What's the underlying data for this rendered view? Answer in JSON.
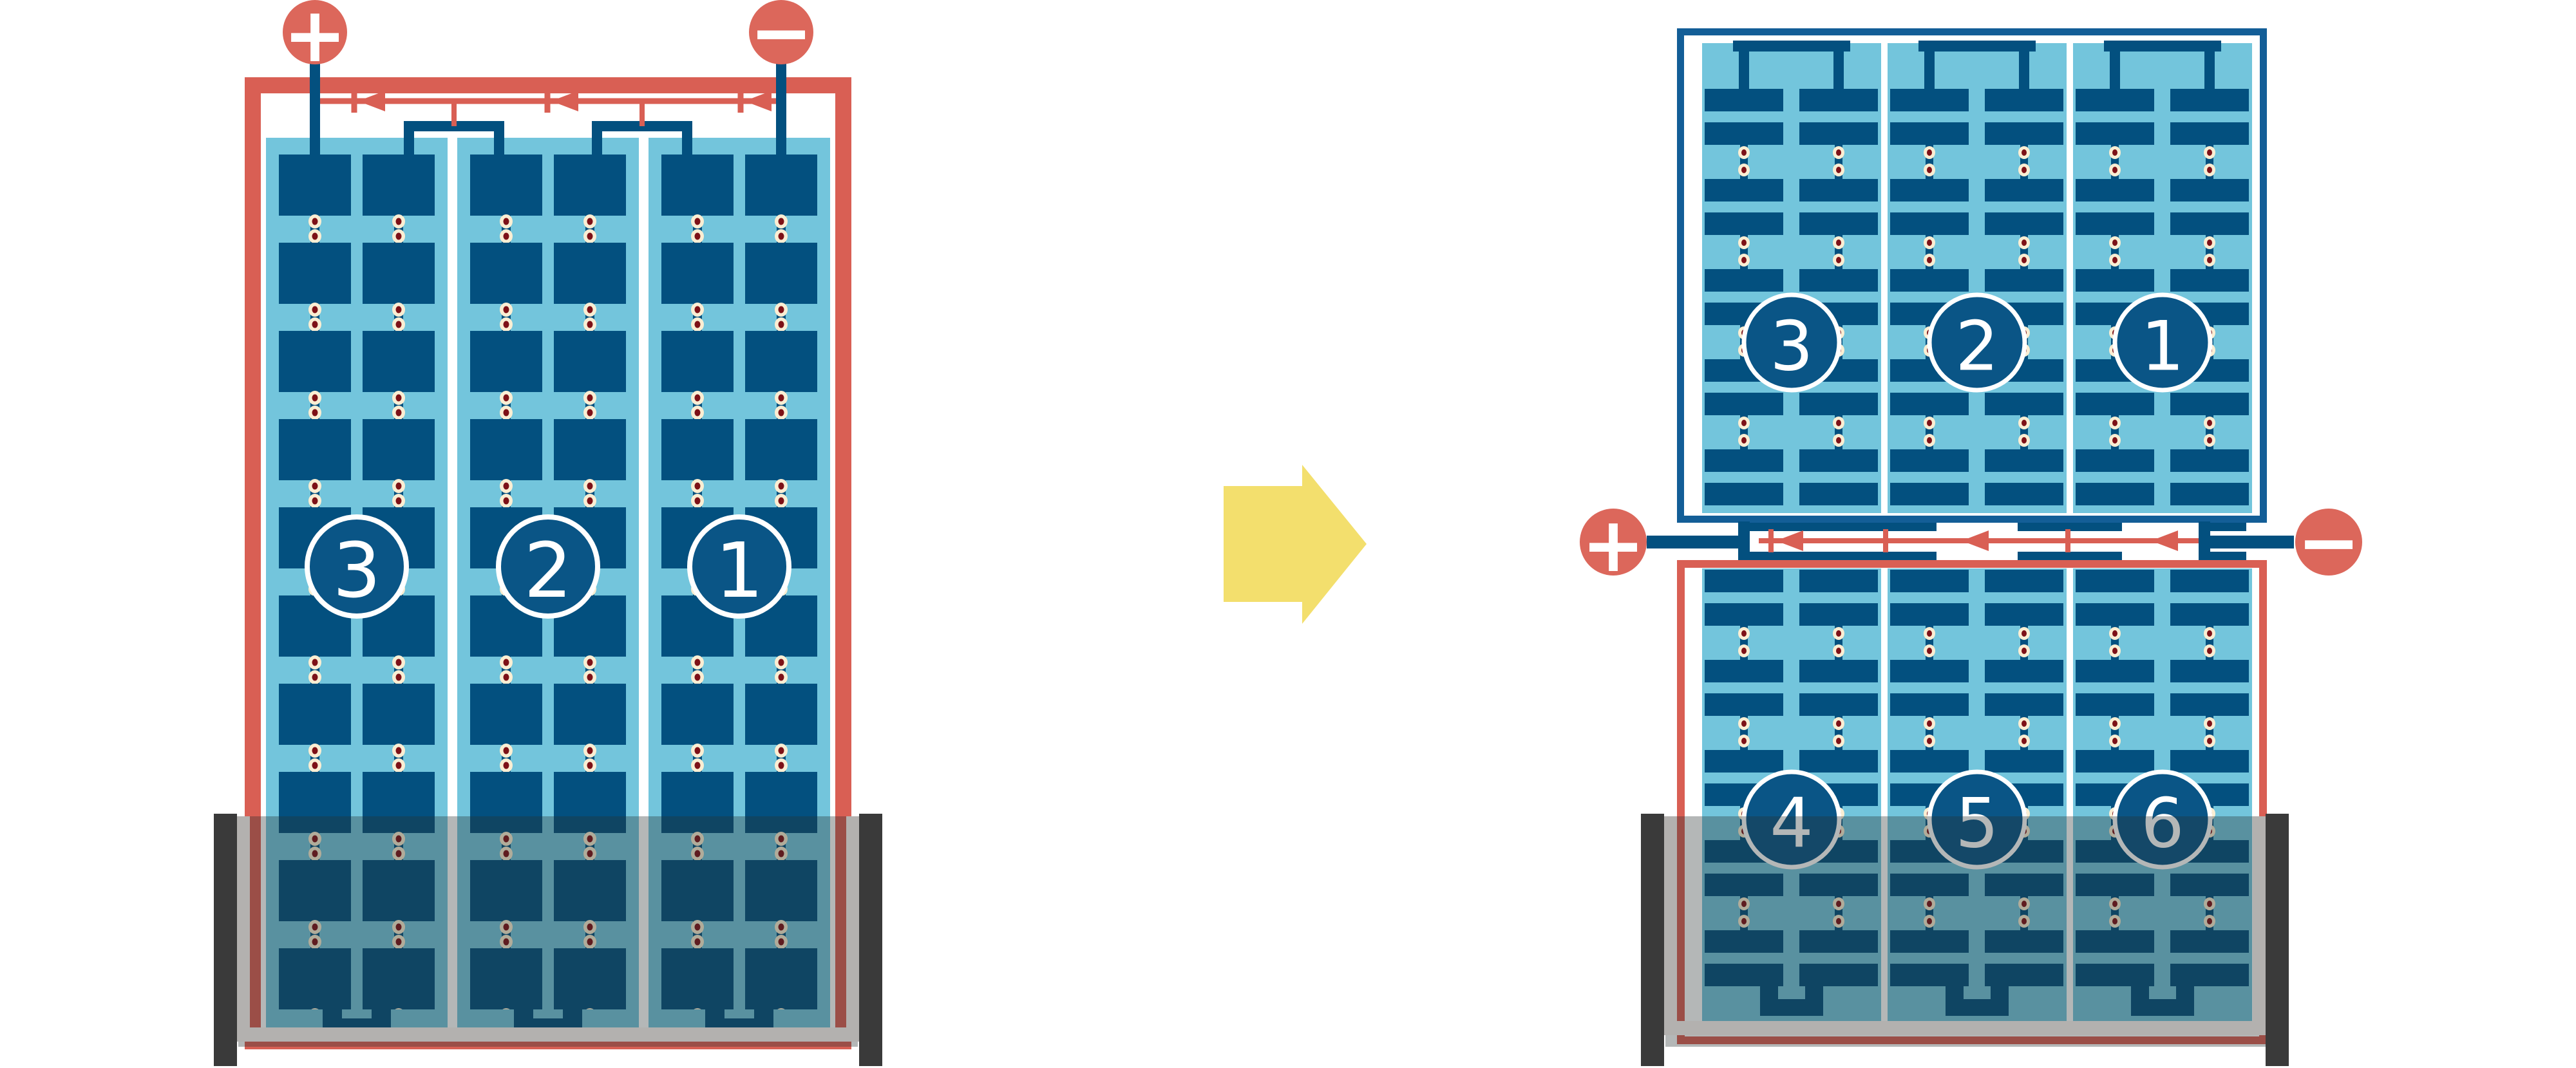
{
  "figure": {
    "description": "battery cell plate-group diagram, single three-cell unit rearranged into stacked six-cell unit",
    "palette": {
      "red": "#D95F54",
      "terminal_red": "#DC675B",
      "navy": "#03507F",
      "navy_frame_light": "#135E97",
      "panel_blue": "#73C5DC",
      "cream_dot": "#FAEED3",
      "dot_center_red": "#7D1117",
      "yellow_arrow": "#F3DF6D",
      "case_dark_gray": "#3A3A3A",
      "case_light_gray": "#B3B1AF",
      "badge_navy": "#0A5586",
      "white": "#FFFFFF"
    },
    "left_unit": {
      "cell_labels": [
        "3",
        "2",
        "1"
      ],
      "positive": "+",
      "negative": "−"
    },
    "right_top_unit": {
      "cell_labels": [
        "3",
        "2",
        "1"
      ]
    },
    "right_bottom_unit": {
      "cell_labels": [
        "4",
        "5",
        "6"
      ],
      "positive": "+",
      "negative": "−"
    }
  }
}
